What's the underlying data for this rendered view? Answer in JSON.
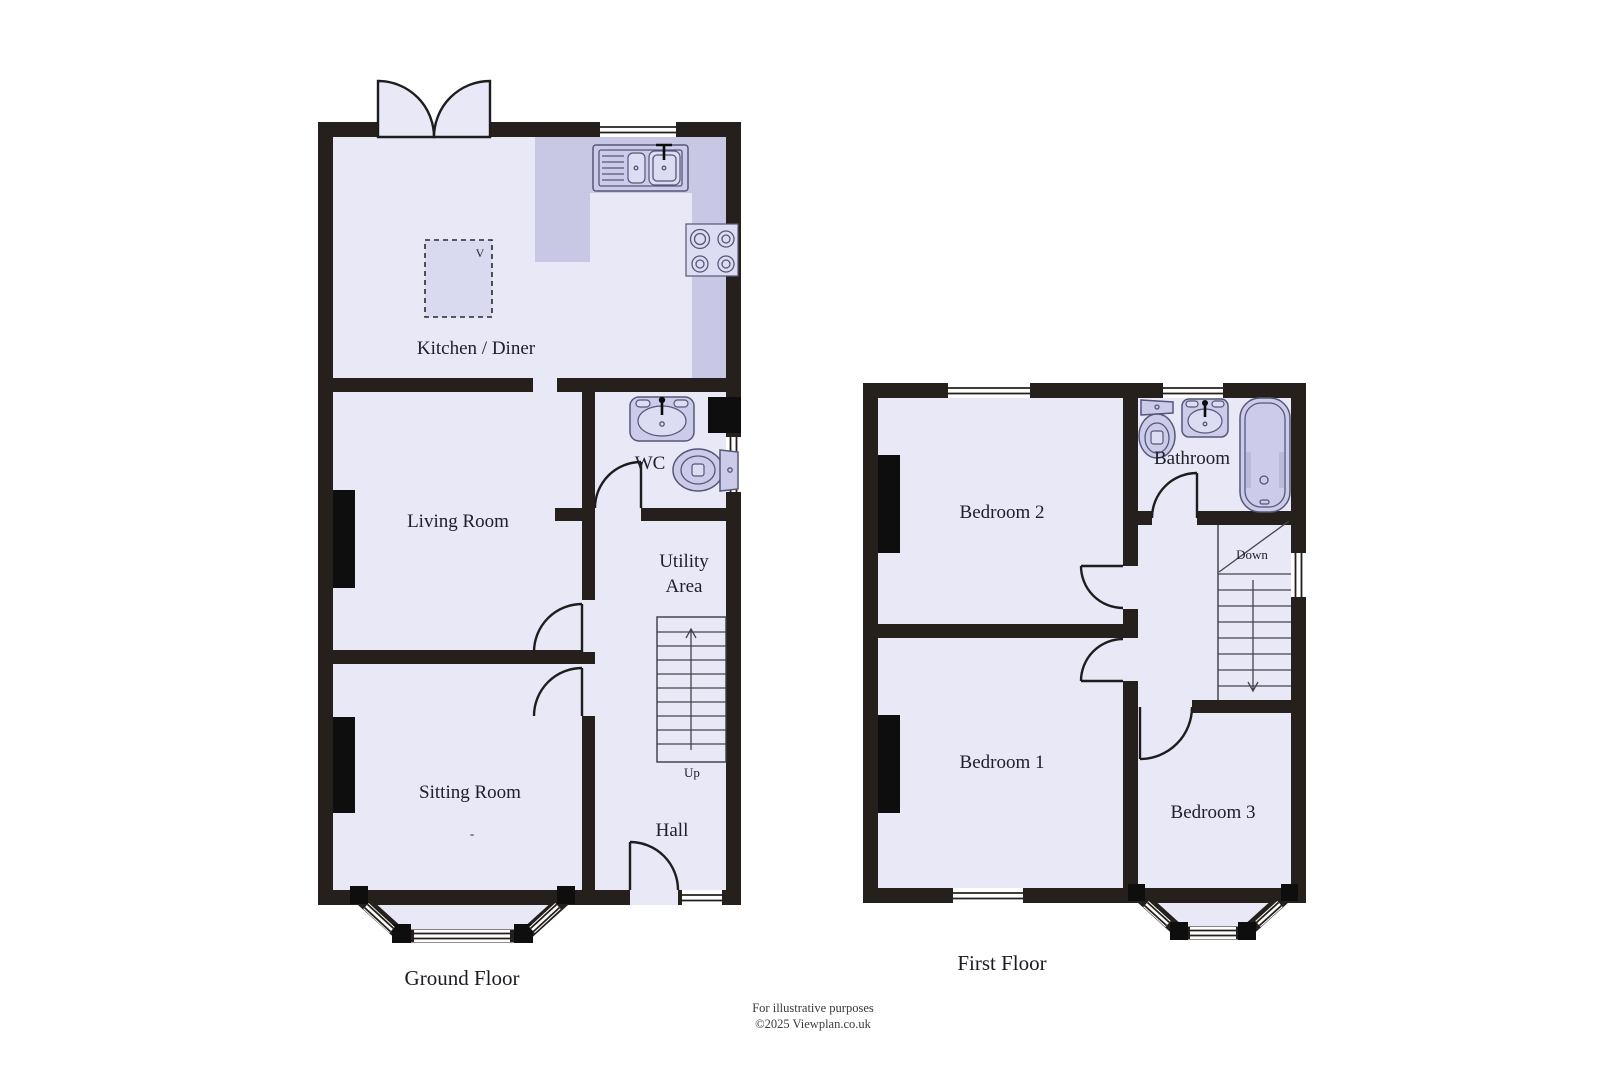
{
  "document_type": "floorplan",
  "ground": {
    "title": "Ground Floor",
    "rooms": {
      "kitchen": "Kitchen / Diner",
      "living": "Living Room",
      "sitting": "Sitting Room",
      "wc": "WC",
      "utility_line1": "Utility",
      "utility_line2": "Area",
      "hall": "Hall"
    },
    "stairs_label": "Up",
    "vent_label": "V",
    "fireplace_mark": "-"
  },
  "first": {
    "title": "First Floor",
    "rooms": {
      "bedroom1": "Bedroom 1",
      "bedroom2": "Bedroom 2",
      "bedroom3": "Bedroom 3",
      "bathroom": "Bathroom"
    },
    "stairs_label": "Down"
  },
  "footer": {
    "line1": "For illustrative purposes",
    "line2": "©2025 Viewplan.co.uk"
  },
  "colors": {
    "wall": "#25201b",
    "room_fill": "#e8e8f6",
    "worktop_fill": "#c8c8e4",
    "fixture_fill": "#ccccea",
    "fixture_stroke": "#565678",
    "chimney": "#0e0e0e",
    "label_text": "#20202c",
    "background": "#ffffff"
  },
  "icons": [
    "kitchen-sink-icon",
    "hob-icon",
    "vent-square",
    "wc-basin-icon",
    "wc-toilet-icon",
    "stairs-up-icon",
    "stairs-down-icon",
    "bath-icon",
    "bathroom-basin-icon",
    "bathroom-toilet-icon",
    "french-doors-icon",
    "bay-window",
    "window",
    "door-arc",
    "chimney-breast"
  ]
}
